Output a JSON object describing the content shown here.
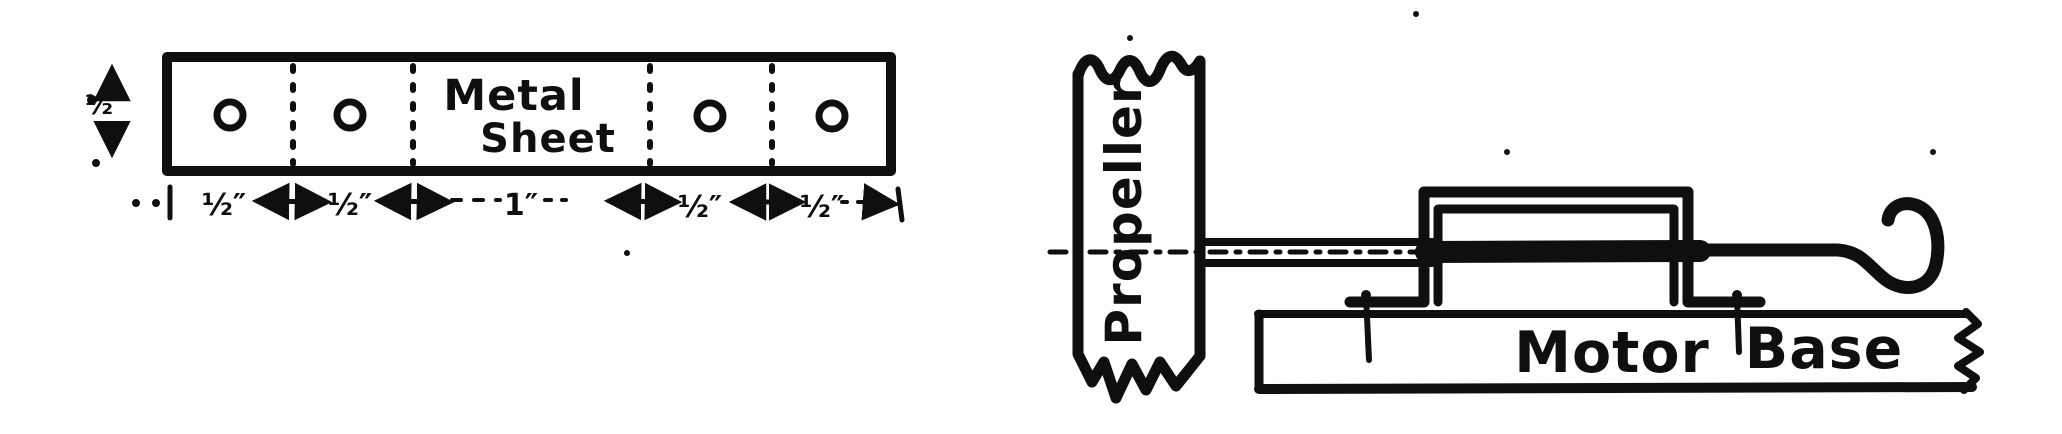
{
  "figure_left": {
    "sheet_label": {
      "line1": "Metal",
      "line2": "Sheet"
    },
    "height_label": "½″",
    "width_labels": [
      "½″",
      "½″",
      "1″",
      "½″",
      "½″"
    ],
    "hole_count": 4
  },
  "figure_right": {
    "propeller_label": "Propeller",
    "base_label": {
      "word1": "Motor",
      "word2": "Base"
    }
  },
  "colors": {
    "ink": "#0f0f0f",
    "paper": "#ffffff"
  }
}
